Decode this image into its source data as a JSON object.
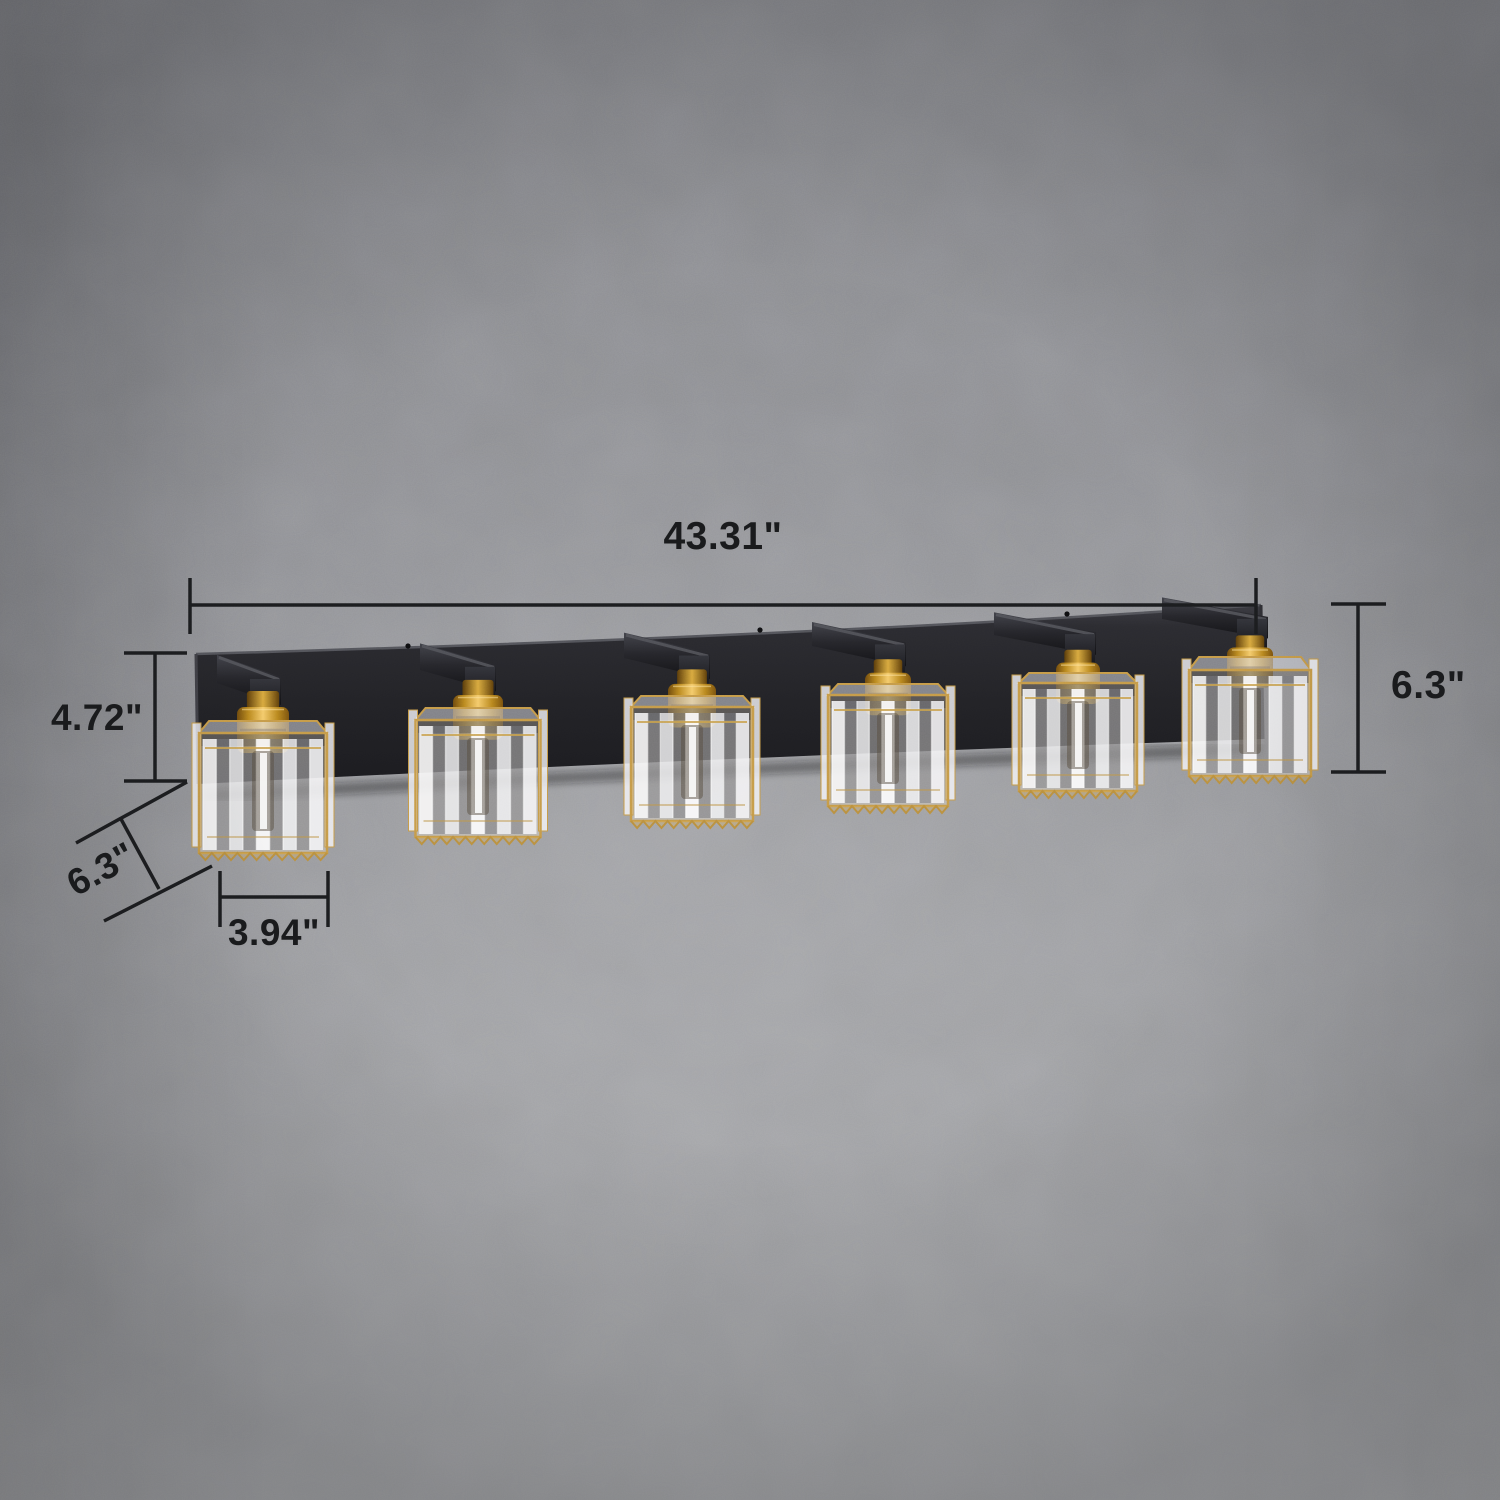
{
  "image": {
    "type": "product dimension photo",
    "subject": "Six-light crystal cube vanity wall light with matte black backplate and brass sockets",
    "background": "gray textured concrete wall"
  },
  "fixture": {
    "light_count": 6,
    "backplate_color": "#232327",
    "arm_color": "#1c1c20",
    "brass_color": "#c8922a",
    "gold_trim_color": "#c59a48",
    "crystal_color": "#f2f2f5"
  },
  "dimensions": {
    "overall_width": "43.31\"",
    "backplate_height": "4.72\"",
    "fixture_height": "6.3\"",
    "shade_depth": "6.3\"",
    "shade_width": "3.94\""
  }
}
